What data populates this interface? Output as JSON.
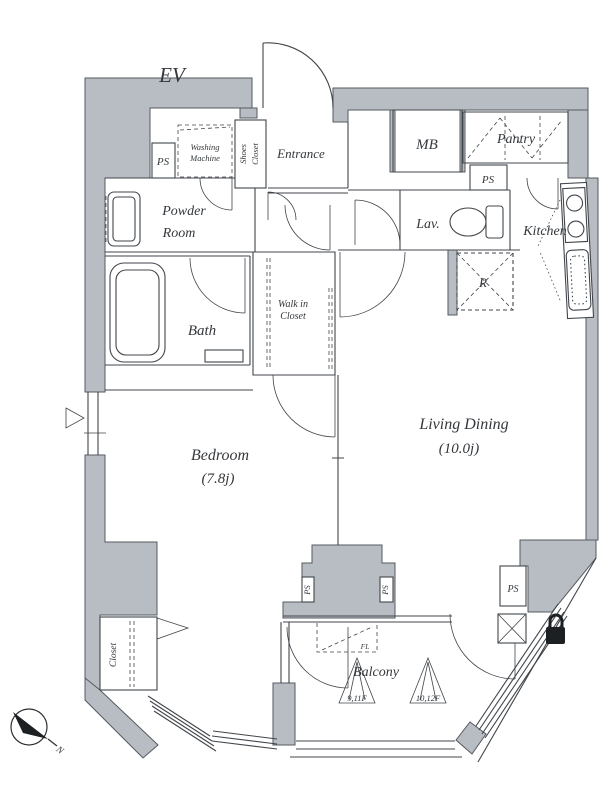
{
  "plan": {
    "colors": {
      "wall_fill": "#b7bdc3",
      "wall_stroke": "#565b60",
      "line": "#41464b",
      "text": "#34383c"
    },
    "labels": {
      "ev": "EV",
      "entrance": "Entrance",
      "mb": "MB",
      "pantry": "Pantry",
      "ps": "PS",
      "washing_machine_line1": "Washing",
      "washing_machine_line2": "Machine",
      "shoes_closet_line1": "Shoes",
      "shoes_closet_line2": "Closet",
      "powder_line1": "Powder",
      "powder_line2": "Room",
      "lav": "Lav.",
      "kitchen": "Kitchen",
      "bath": "Bath",
      "wic_line1": "Walk in",
      "wic_line2": "Closet",
      "fridge": "R",
      "bedroom": "Bedroom",
      "bedroom_area": "(7.8j)",
      "living": "Living Dining",
      "living_area": "(10.0j)",
      "closet": "Closet",
      "balcony": "Balcony",
      "hatch_floors_a": "9,11F",
      "hatch_floors_b": "10,12F",
      "fl": "FL",
      "north": "N"
    }
  }
}
